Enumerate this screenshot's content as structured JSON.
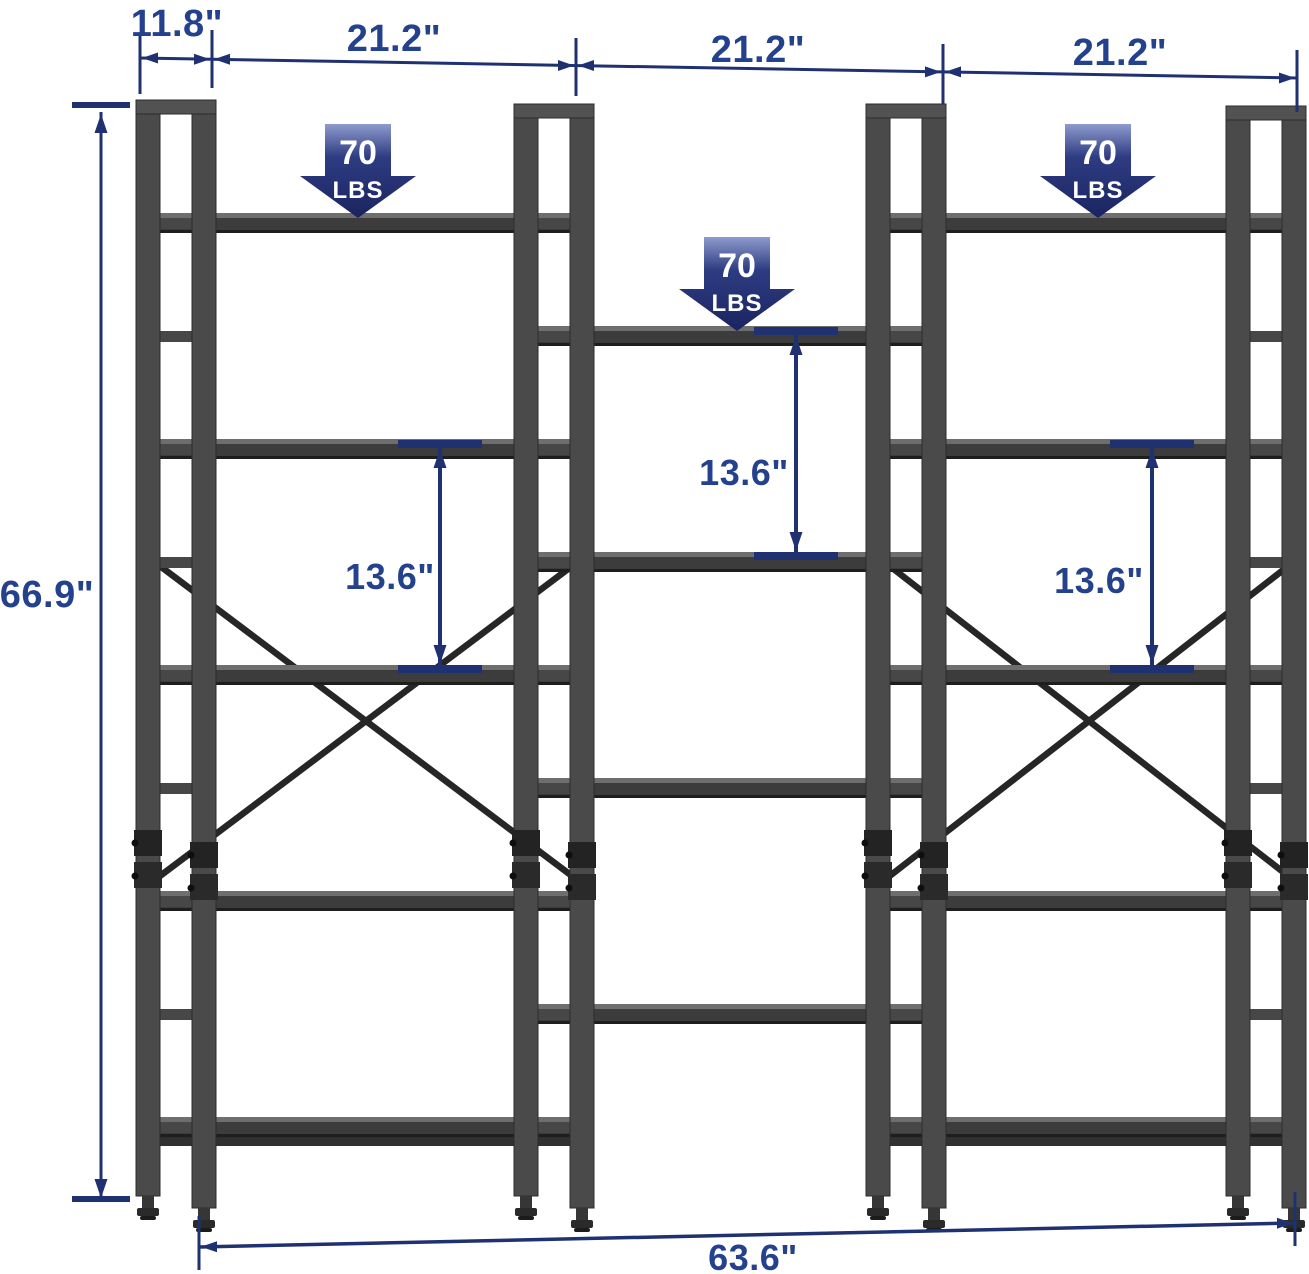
{
  "diagram": {
    "description": "Dimension diagram of a triple-wide tiered metal bookshelf"
  },
  "dimensions": {
    "depth_label": "11.8\"",
    "section_width_labels": [
      "21.2\"",
      "21.2\"",
      "21.2\""
    ],
    "height_label": "66.9\"",
    "total_width_label": "63.6\"",
    "shelf_spacing_labels": [
      "13.6\"",
      "13.6\"",
      "13.6\""
    ]
  },
  "capacity_badges": [
    {
      "value": "70",
      "unit": "LBS"
    },
    {
      "value": "70",
      "unit": "LBS"
    },
    {
      "value": "70",
      "unit": "LBS"
    }
  ],
  "structure": {
    "sections": 3,
    "side_section_shelves": 5,
    "middle_section_shelves": 4,
    "cross_braces": 2,
    "vertical_frames": 4
  },
  "colors": {
    "background": "#FFFFFF",
    "dimension_line": "#1F3170",
    "dimension_text": "#24418E",
    "badge_gradient_top": "#8E9BCE",
    "badge_gradient_mid": "#2E3C82",
    "badge_gradient_bottom": "#1A2460",
    "badge_text": "#FFFFFF",
    "frame_mid": "#4A4A4A",
    "frame_cap": "#525252",
    "rung": "#474747",
    "shelf_top_highlight": "#6E6E6E",
    "shelf_board": "#3C3C3C",
    "shelf_shadow": "#1E1E1E",
    "brace": "#262626"
  }
}
